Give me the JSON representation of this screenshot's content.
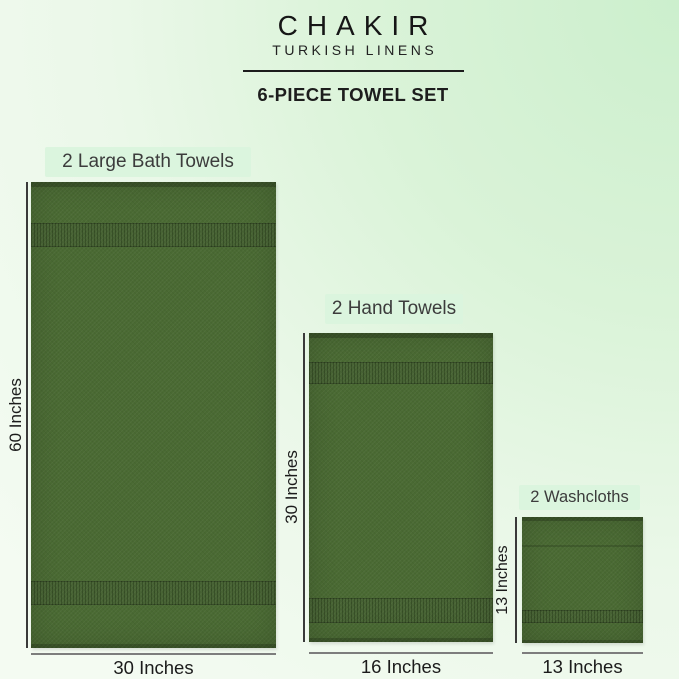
{
  "brand": {
    "name": "CHAKIR",
    "tagline": "TURKISH LINENS"
  },
  "title": "6-PIECE TOWEL SET",
  "palette": {
    "towel_green": "#4a6a33",
    "towel_band_green": "#3f5f2b",
    "background_mint": "#ccefcd",
    "label_box_green": "#dbf5de",
    "text_dark": "#1b1b1b"
  },
  "products": [
    {
      "label": "2 Large Bath Towels",
      "height_label": "60 Inches",
      "width_label": "30 Inches"
    },
    {
      "label": "2 Hand Towels",
      "height_label": "30 Inches",
      "width_label": "16 Inches"
    },
    {
      "label": "2 Washcloths",
      "height_label": "13 Inches",
      "width_label": "13 Inches"
    }
  ]
}
